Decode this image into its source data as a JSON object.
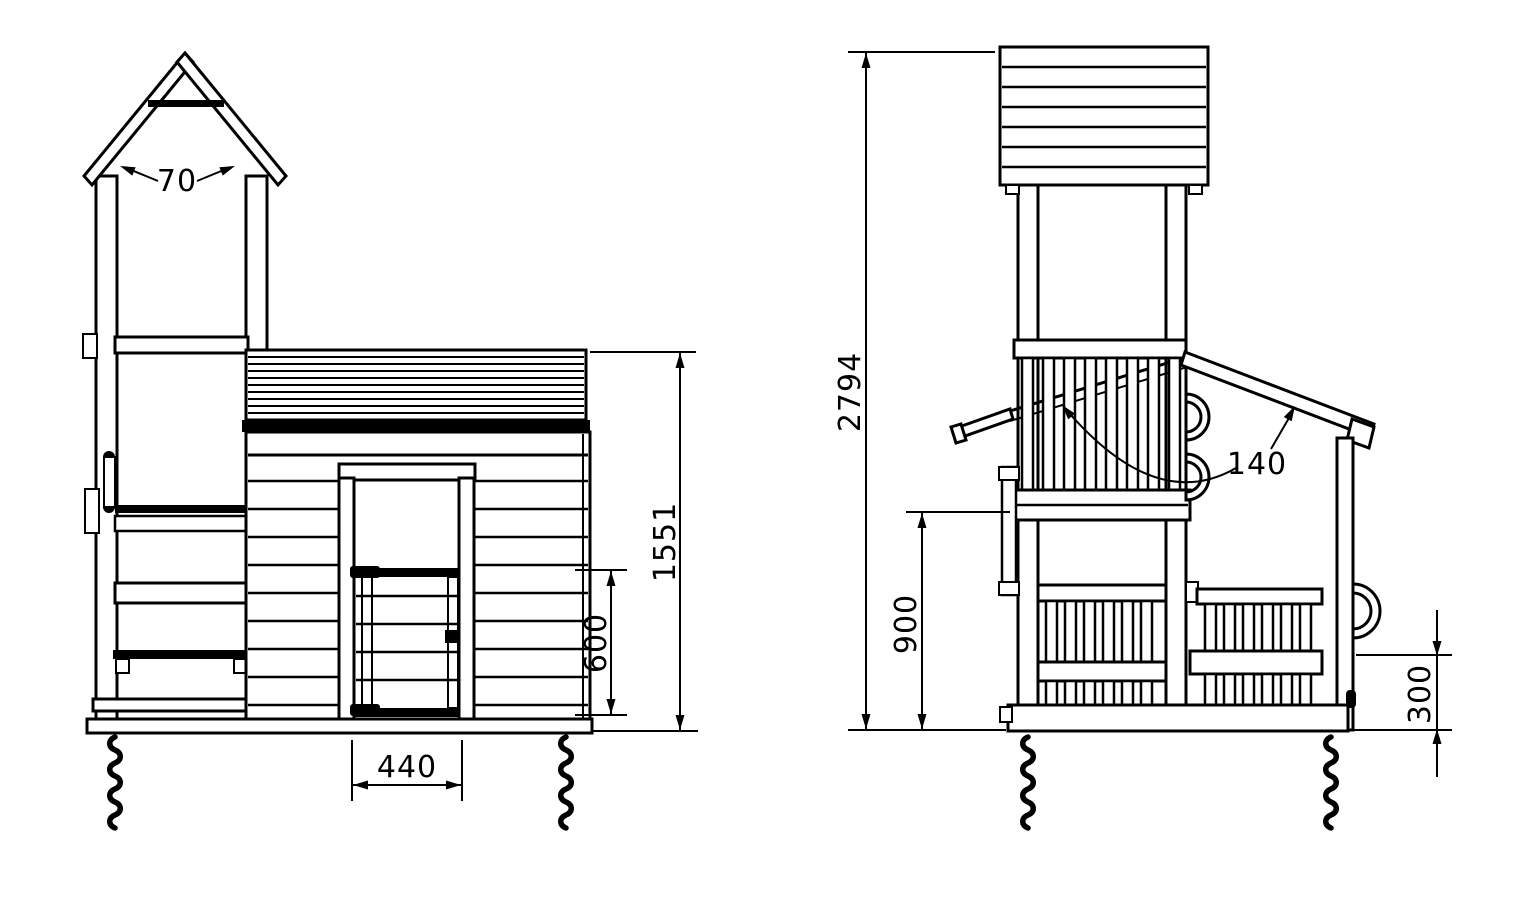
{
  "drawing": {
    "type": "technical-elevation-drawing",
    "colors": {
      "line": "#000000",
      "background": "#ffffff"
    },
    "front_view": {
      "dims": {
        "tower_rafter": "70",
        "eave_height": "1551",
        "gate_height": "600",
        "door_width": "440"
      }
    },
    "side_view": {
      "dims": {
        "total_height": "2794",
        "platform_height": "900",
        "house_rafter": "140",
        "rail_height": "300"
      }
    }
  }
}
